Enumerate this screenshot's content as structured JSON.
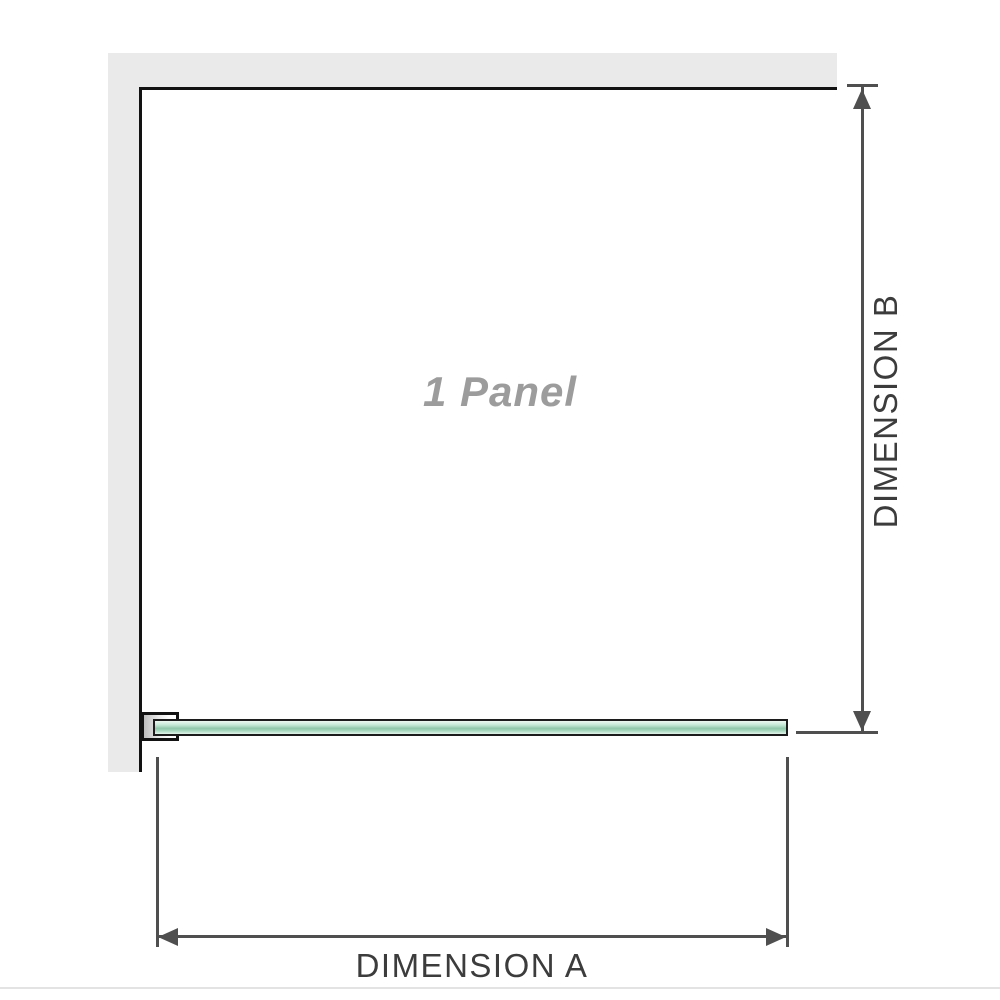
{
  "diagram": {
    "panel_label": "1 Panel",
    "dimension_a": {
      "label": "DIMENSION A"
    },
    "dimension_b": {
      "label": "DIMENSION B"
    }
  },
  "icons": {
    "arrow_up": "dimension-b upper end arrow",
    "arrow_down": "dimension-b lower end arrow",
    "arrow_left": "dimension-a left end arrow",
    "arrow_right": "dimension-a right end arrow"
  },
  "colors": {
    "wall": "#eaeaea",
    "wall_edge": "#121212",
    "glass_outline": "#1c1c1c",
    "glass_fill_light": "#e2f3e9",
    "glass_fill_mid": "#c6e8d6",
    "glass_fill_dark": "#8fc7a9",
    "dimension": "#4f4f4f",
    "label_text": "#3c3c3c",
    "panel_label_text": "#9c9c9c",
    "divider": "#e3e3e3"
  }
}
